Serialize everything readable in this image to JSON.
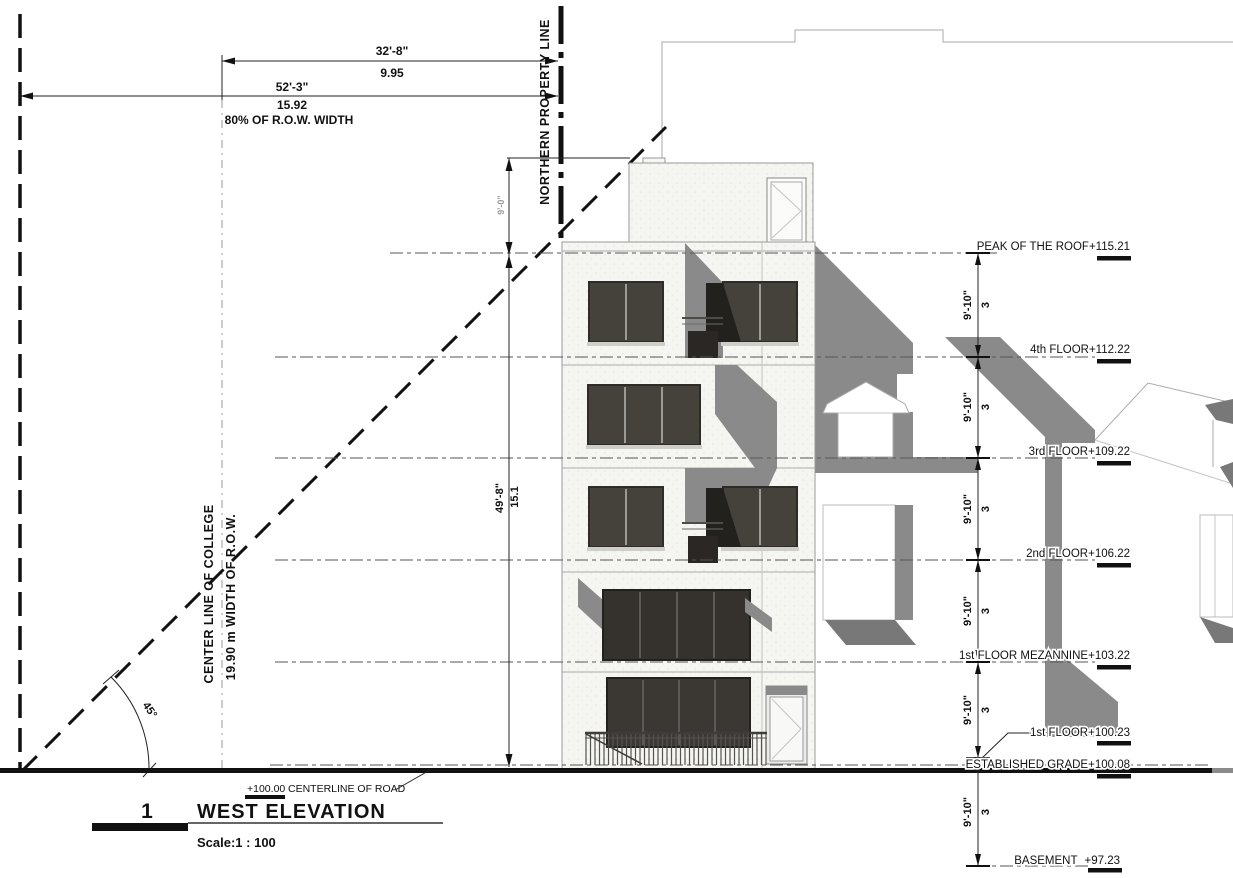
{
  "drawing": {
    "number": "1",
    "title": "WEST ELEVATION",
    "scale": "Scale:1 : 100"
  },
  "road": {
    "elevation": "+100.00",
    "label": "CENTERLINE OF ROAD"
  },
  "property": {
    "north_line": "NORTHERN PROPERTY LINE",
    "center_line": "CENTER LINE OF COLLEGE",
    "row_width": "19.90 m WIDTH OF R.O.W."
  },
  "dimensions": {
    "top_upper": {
      "imperial": "32'-8\"",
      "metric": "9.95"
    },
    "top_lower": {
      "imperial": "52'-3\"",
      "metric": "15.92",
      "note": "80% OF R.O.W. WIDTH"
    },
    "penthouse_height": "9'-0\"",
    "building_height": {
      "imperial": "49'-8\"",
      "metric": "15.1"
    },
    "floor_spacing": "9'-10\"",
    "floor_spacing_m": "3",
    "angle": "45°"
  },
  "levels": [
    {
      "label": "PEAK OF THE ROOF",
      "elevation": "+115.21"
    },
    {
      "label": "4th FLOOR",
      "elevation": "+112.22"
    },
    {
      "label": "3rd FLOOR",
      "elevation": "+109.22"
    },
    {
      "label": "2nd FLOOR",
      "elevation": "+106.22"
    },
    {
      "label": "1st FLOOR MEZANNINE",
      "elevation": "+103.22"
    },
    {
      "label": "1st FLOOR",
      "elevation": "+100.23"
    },
    {
      "label": "ESTABLISHED GRADE",
      "elevation": "+100.08"
    },
    {
      "label": "BASEMENT",
      "elevation": "+97.23"
    }
  ],
  "colors": {
    "c-paper": "#ffffff",
    "c-ink": "#111111",
    "c-shadow": "#8a8a8a",
    "c-window": "#45413b",
    "c-window-dark": "#23211e",
    "c-facade": "#f5f5f2"
  }
}
